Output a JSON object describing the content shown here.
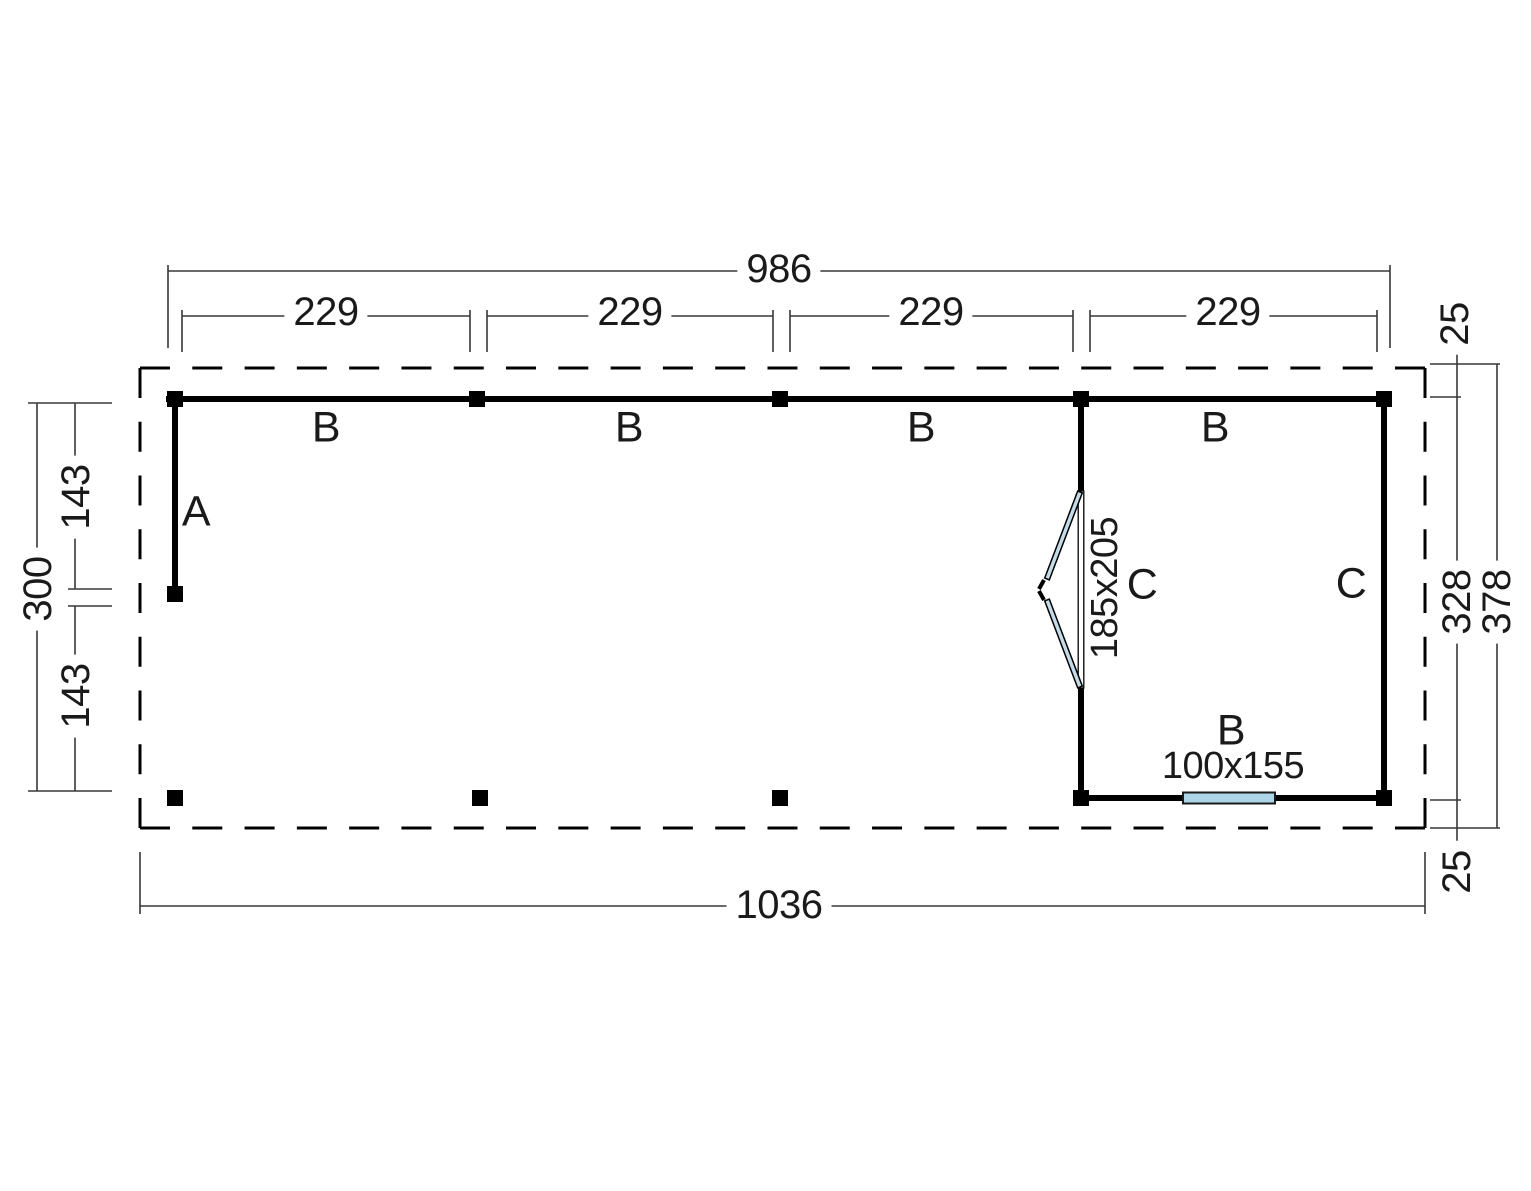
{
  "drawing": {
    "type": "floor-plan",
    "units": "cm"
  },
  "colors": {
    "wall": "#000000",
    "dim_line": "#383838",
    "glass": "#aed5e7",
    "door_leaf": "#c3dcea",
    "background": "#ffffff"
  },
  "dims": {
    "top_total": "986",
    "bays": [
      "229",
      "229",
      "229",
      "229"
    ],
    "overhang_top": "25",
    "depth_inner": "328",
    "depth_outer": "378",
    "overhang_bottom": "25",
    "left_total": "300",
    "left_upper": "143",
    "left_lower": "143",
    "bottom_total": "1036"
  },
  "labels": {
    "wall_a": "A",
    "beams": [
      "B",
      "B",
      "B",
      "B"
    ],
    "room_c_door": "C",
    "room_c_side": "C",
    "door_size": "185x205",
    "window_beam": "B",
    "window_size": "100x155"
  }
}
